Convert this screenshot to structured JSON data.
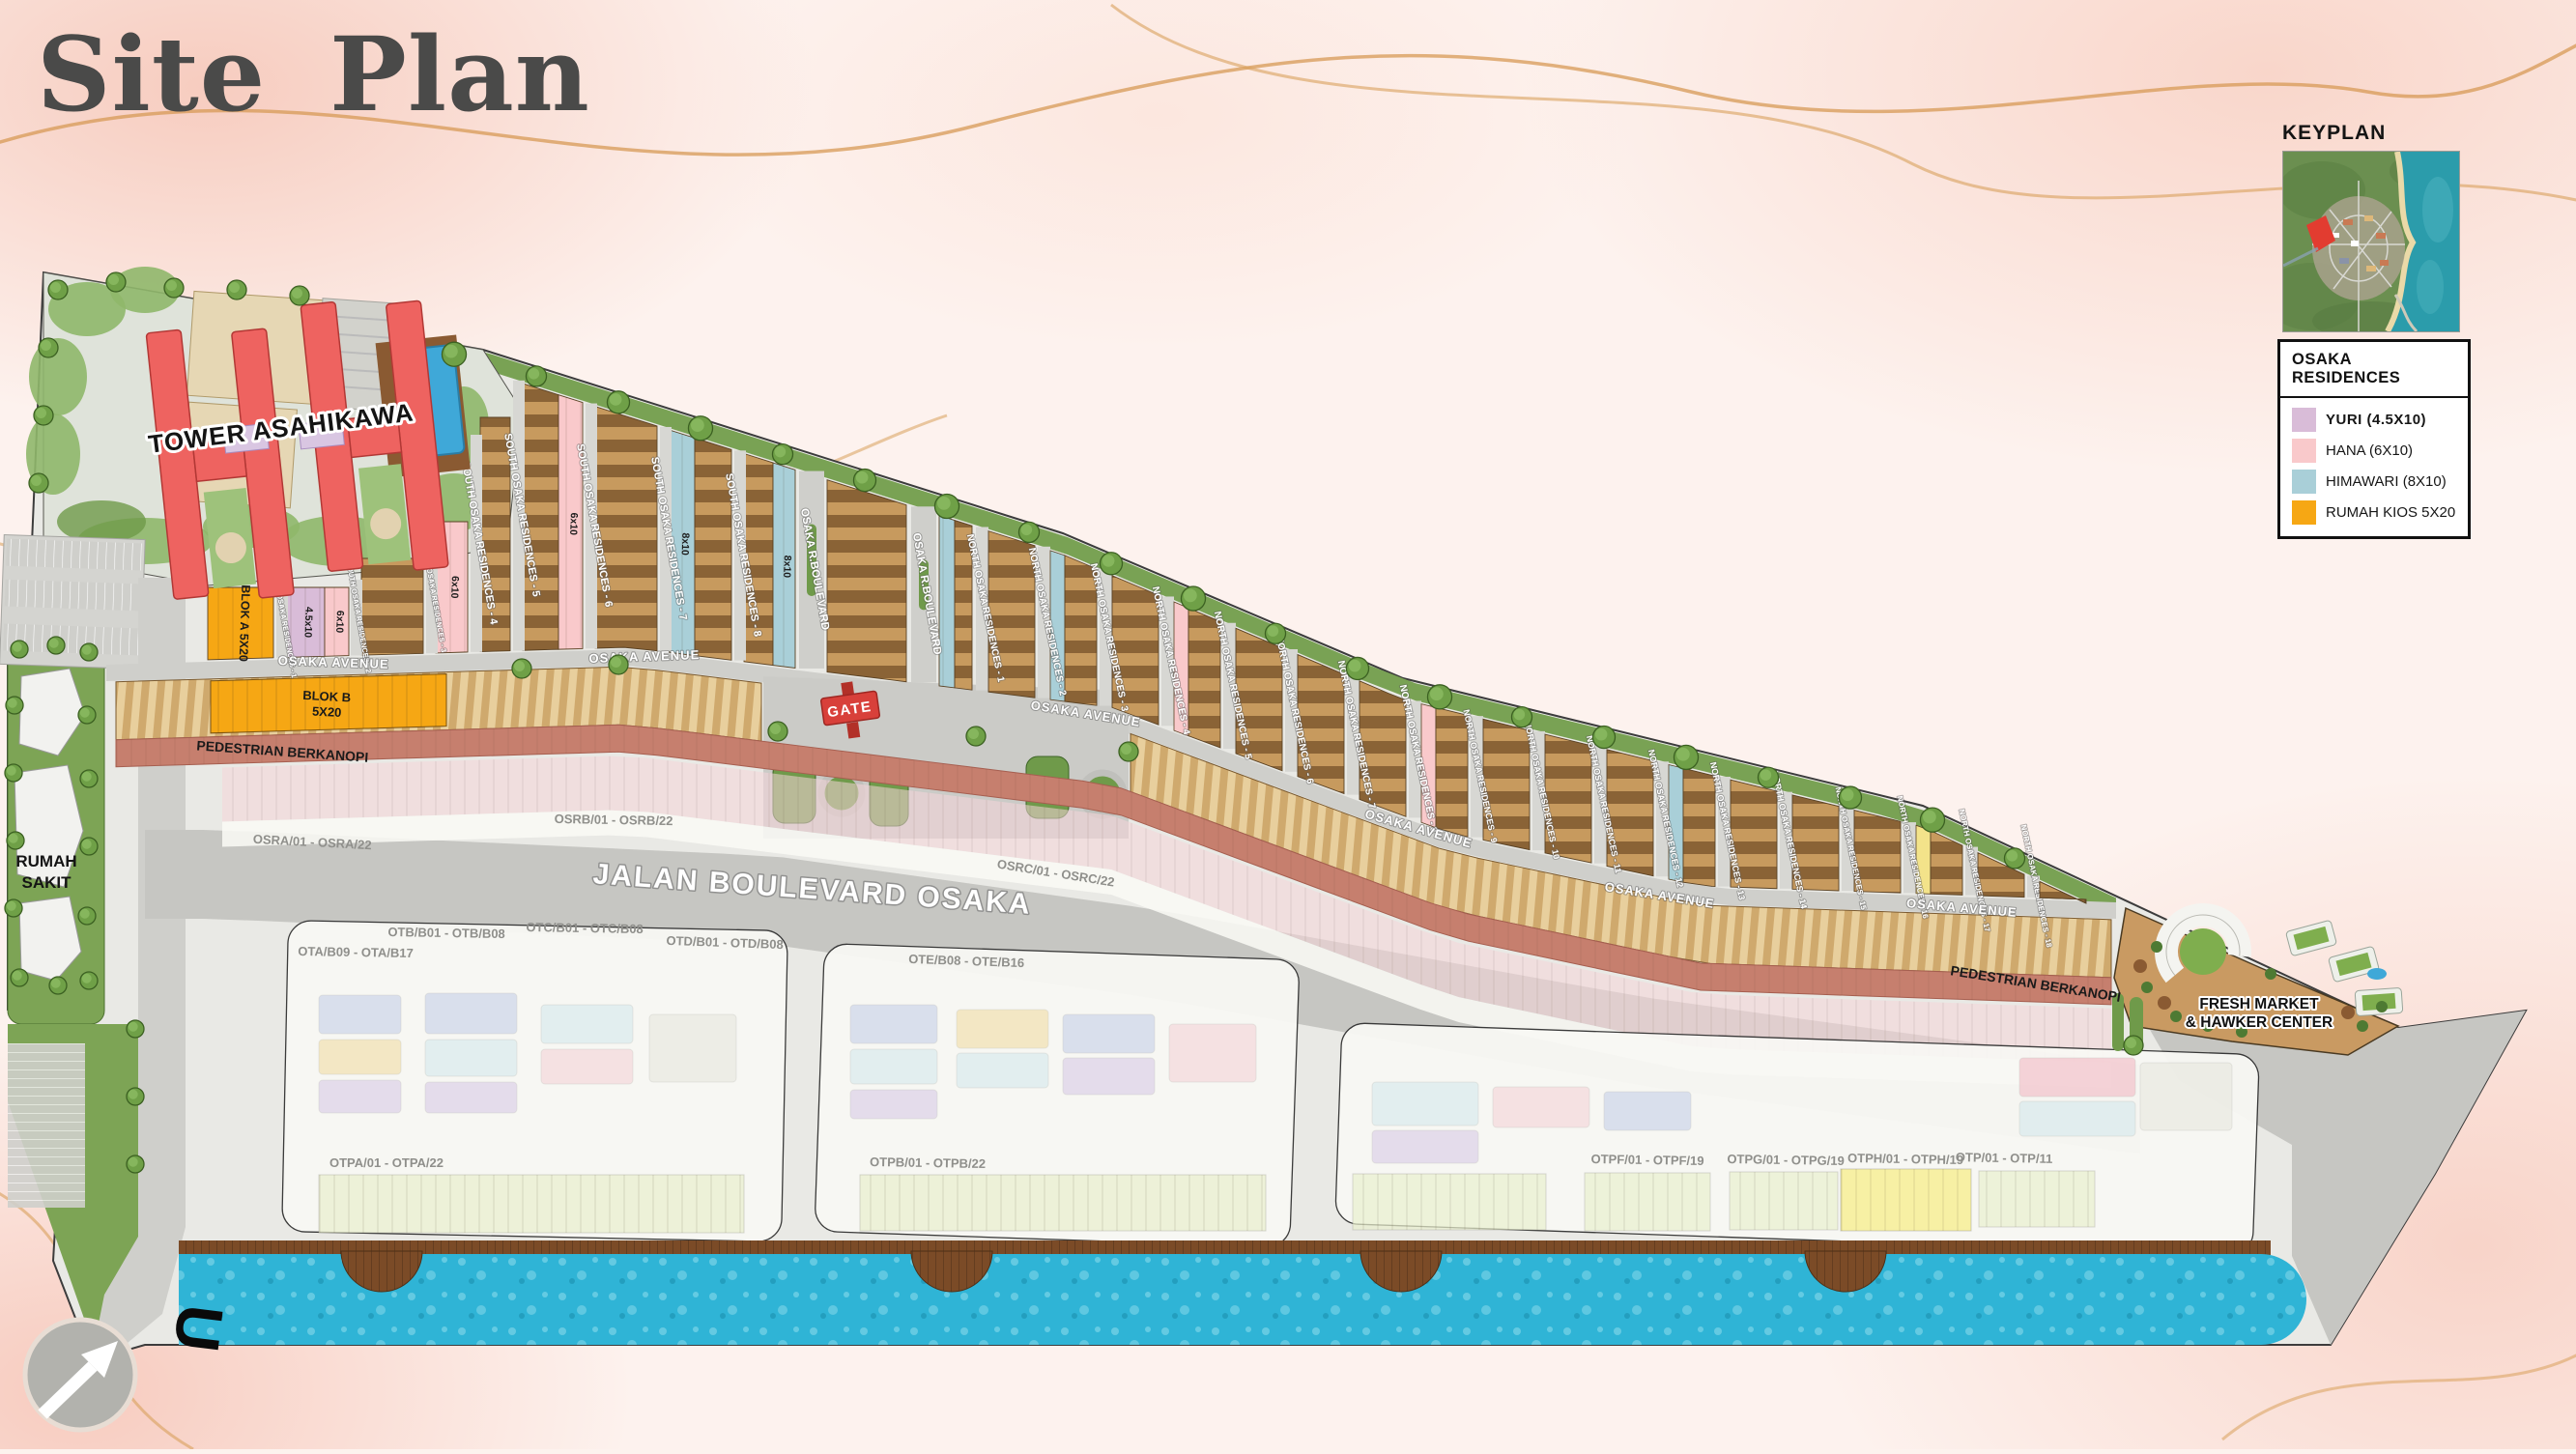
{
  "title": "Site Plan",
  "keyplan": {
    "label": "KEYPLAN"
  },
  "legend": {
    "title": "OSAKA RESIDENCES",
    "items": [
      {
        "label": "YURI (4.5X10)",
        "color": "#d9bcd8",
        "bold": true
      },
      {
        "label": "HANA (6X10)",
        "color": "#f9c9cb",
        "bold": false
      },
      {
        "label": "HIMAWARI (8X10)",
        "color": "#a9cfd8",
        "bold": false
      },
      {
        "label": "RUMAH KIOS 5X20",
        "color": "#f6a714",
        "bold": false
      }
    ]
  },
  "map": {
    "landmarks": {
      "tower": "TOWER ASAHIKAWA",
      "hospital_line1": "RUMAH",
      "hospital_line2": "SAKIT",
      "gate": "GATE",
      "market_line1": "FRESH MARKET",
      "market_line2": "& HAWKER CENTER",
      "north_arrow": "U"
    },
    "streets": {
      "boulevard": "JALAN BOULEVARD OSAKA",
      "avenue": "OSAKA AVENUE",
      "r_boulevard": "OSAKA R.BOULEVARD",
      "pedestrian": "PEDESTRIAN BERKANOPI"
    },
    "blocks": {
      "blok_a": "BLOK A 5X20",
      "blok_b_line1": "BLOK B",
      "blok_b_line2": "5X20"
    },
    "sizes": {
      "yuri": "4.5x10",
      "hana": "6x10",
      "himawari": "8x10"
    },
    "south_streets": [
      "SOUTH OSAKA RESIDENCES - 1",
      "SOUTH OSAKA RESIDENCES - 2",
      "SOUTH OSAKA RESIDENCES - 3",
      "SOUTH OSAKA RESIDENCES - 4",
      "SOUTH OSAKA RESIDENCES - 5",
      "SOUTH OSAKA RESIDENCES - 6",
      "SOUTH OSAKA RESIDENCES - 7",
      "SOUTH OSAKA RESIDENCES - 8"
    ],
    "north_streets": [
      "NORTH OSAKA RESIDENCES - 1",
      "NORTH OSAKA RESIDENCES - 2",
      "NORTH OSAKA RESIDENCES - 3",
      "NORTH OSAKA RESIDENCES - 4",
      "NORTH OSAKA RESIDENCES - 5",
      "NORTH OSAKA RESIDENCES - 6",
      "NORTH OSAKA RESIDENCES - 7",
      "NORTH OSAKA RESIDENCES - 8",
      "NORTH OSAKA RESIDENCES - 9",
      "NORTH OSAKA RESIDENCES - 10",
      "NORTH OSAKA RESIDENCES - 11",
      "NORTH OSAKA RESIDENCES - 12",
      "NORTH OSAKA RESIDENCES - 13",
      "NORTH OSAKA RESIDENCES - 14",
      "NORTH OSAKA RESIDENCES - 15",
      "NORTH OSAKA RESIDENCES - 16",
      "NORTH OSAKA RESIDENCES - 17",
      "NORTH OSAKA RESIDENCES - 18"
    ],
    "phases": [
      "OSRA/01 - OSRA/22",
      "OSRB/01 - OSRB/22",
      "OSRC/01 - OSRC/22",
      "OTA/B09 - OTA/B17",
      "OTB/B01 - OTB/B08",
      "OTC/B01 - OTC/B08",
      "OTD/B01 - OTD/B08",
      "OTE/B08 - OTE/B16",
      "OTPA/01 - OTPA/22",
      "OTPB/01 - OTPB/22",
      "OTPF/01 - OTPF/19",
      "OTPG/01 - OTPG/19",
      "OTPH/01 - OTPH/19",
      "OTP/01 - OTP/11"
    ]
  }
}
